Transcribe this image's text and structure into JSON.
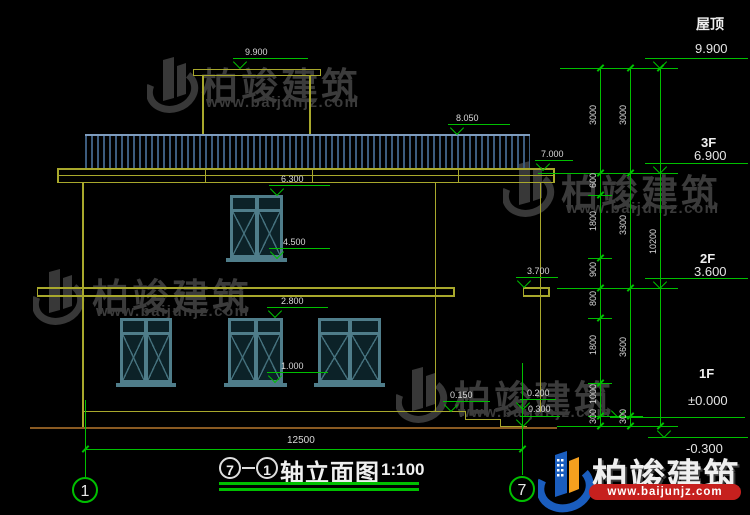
{
  "brand": {
    "name": "柏竣建筑",
    "url": "www.baijunjz.com"
  },
  "title_block": {
    "axis_start": "7",
    "separator": "-",
    "axis_end": "1",
    "name": "轴立面图",
    "scale": "1:100"
  },
  "grid": {
    "left_bubble": "1",
    "right_bubble": "7",
    "overall_dim": "12500"
  },
  "elevation_marks": {
    "m9900": "9.900",
    "m8050": "8.050",
    "m7000": "7.000",
    "m6300": "6.300",
    "m4500": "4.500",
    "m3700": "3.700",
    "m2800": "2.800",
    "m1000": "1.000",
    "m0150": "0.150",
    "m0200": "0.200",
    "m0300": "0.300"
  },
  "floor_levels": [
    {
      "floor": "屋顶",
      "value": "9.900"
    },
    {
      "floor": "3F",
      "value": "6.900"
    },
    {
      "floor": "2F",
      "value": "3.600"
    },
    {
      "floor": "1F",
      "value": "±0.000"
    },
    {
      "floor": "",
      "value": "-0.300"
    }
  ],
  "dim_chains": {
    "inner": [
      "3000",
      "600",
      "1800",
      "900",
      "800",
      "1800",
      "1000",
      "300"
    ],
    "middle": [
      "3000",
      "3300",
      "3600",
      "300"
    ],
    "outer": [
      "10200"
    ]
  }
}
